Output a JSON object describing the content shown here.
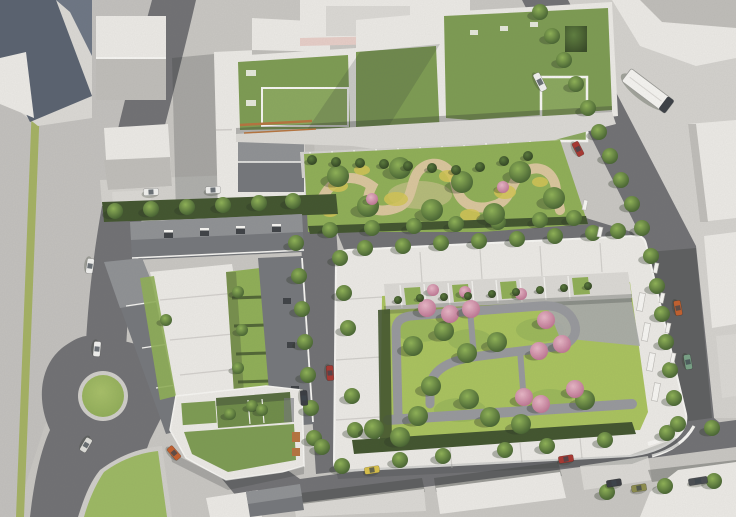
{
  "colors": {
    "pavement": "#c8c6c2",
    "pavement_left": "#c2c0bd",
    "pavement_light": "#d3d1cd",
    "road": "#717174",
    "island": "#cfcdc9",
    "verge": "#a4b163",
    "grass_island": "#9cb863",
    "lawn": "#8fae57",
    "lawn_bright": "#a9c25e",
    "lawn_dark": "#6f8c49",
    "green_roof": "#7d9b53",
    "green_roof_light": "#8aa75e",
    "hedge": "#42552f",
    "sand": "#d9c59c",
    "flower_yellow": "#d2c455",
    "building": "#ebe9e5",
    "building_mid": "#dad8d4",
    "building_shadow": "#bfbdb9",
    "roof_grey": "#75777b",
    "roof_grey_light": "#8f9194",
    "roof_slate": "#5a6270",
    "roof_slate_light": "#6d7684",
    "pink_parapet": "#e6cdc7",
    "orange_balcony": "#b5743f",
    "plaza_grey": "#a9aaac",
    "path_grey": "#97989c",
    "shadow": "#2e3230",
    "chimney": "#3f4246",
    "tree_light": "#8fb257",
    "tree_dark": "#3f5a2e",
    "bush_light": "#5a7a3c",
    "bush_dark": "#2c3d1f",
    "pink_light": "#e7b6c6",
    "pink_dark": "#b96e8d",
    "grass_light": "#a7bf68",
    "grass_dark": "#8aa754"
  },
  "scene": {
    "roundabout": {
      "cx": 103,
      "cy": 396,
      "r": 21
    },
    "bus": {
      "x": 648,
      "y": 91,
      "rot": 37,
      "w": 54,
      "h": 16
    },
    "trees": {
      "street": [
        [
          540,
          12
        ],
        [
          552,
          36
        ],
        [
          564,
          60
        ],
        [
          576,
          84
        ],
        [
          588,
          108
        ],
        [
          599,
          132
        ],
        [
          610,
          156
        ],
        [
          621,
          180
        ],
        [
          632,
          204
        ],
        [
          642,
          228
        ],
        [
          651,
          256
        ],
        [
          657,
          286
        ],
        [
          662,
          314
        ],
        [
          666,
          342
        ],
        [
          670,
          370
        ],
        [
          674,
          398
        ],
        [
          678,
          424
        ],
        [
          365,
          248
        ],
        [
          403,
          246
        ],
        [
          441,
          243
        ],
        [
          479,
          241
        ],
        [
          517,
          239
        ],
        [
          555,
          236
        ],
        [
          593,
          233
        ],
        [
          618,
          231
        ],
        [
          330,
          230
        ],
        [
          372,
          228
        ],
        [
          414,
          226
        ],
        [
          456,
          224
        ],
        [
          498,
          222
        ],
        [
          540,
          220
        ],
        [
          574,
          218
        ],
        [
          115,
          211
        ],
        [
          151,
          209
        ],
        [
          187,
          207
        ],
        [
          223,
          205
        ],
        [
          259,
          203
        ],
        [
          293,
          201
        ],
        [
          296,
          243
        ],
        [
          299,
          276
        ],
        [
          302,
          309
        ],
        [
          305,
          342
        ],
        [
          308,
          375
        ],
        [
          311,
          408
        ],
        [
          314,
          438
        ],
        [
          340,
          258
        ],
        [
          344,
          293
        ],
        [
          348,
          328
        ],
        [
          352,
          396
        ],
        [
          355,
          430
        ],
        [
          342,
          466
        ],
        [
          400,
          460
        ],
        [
          443,
          456
        ],
        [
          505,
          450
        ],
        [
          547,
          446
        ],
        [
          605,
          440
        ],
        [
          667,
          433
        ],
        [
          712,
          428
        ],
        [
          607,
          492
        ],
        [
          665,
          486
        ],
        [
          714,
          481
        ],
        [
          322,
          447
        ]
      ],
      "park": [
        [
          338,
          176
        ],
        [
          400,
          168
        ],
        [
          462,
          182
        ],
        [
          520,
          172
        ],
        [
          554,
          198
        ],
        [
          368,
          206
        ],
        [
          432,
          210
        ],
        [
          494,
          214
        ]
      ],
      "courtyard": [
        [
          413,
          346
        ],
        [
          444,
          331
        ],
        [
          467,
          353
        ],
        [
          431,
          386
        ],
        [
          469,
          399
        ],
        [
          497,
          342
        ],
        [
          418,
          416
        ],
        [
          490,
          417
        ],
        [
          374,
          429
        ],
        [
          400,
          437
        ],
        [
          521,
          424
        ],
        [
          585,
          400
        ]
      ],
      "pink_courtyard": [
        [
          427,
          308
        ],
        [
          450,
          314
        ],
        [
          471,
          309
        ],
        [
          546,
          320
        ],
        [
          562,
          344
        ],
        [
          539,
          351
        ],
        [
          524,
          397
        ],
        [
          541,
          404
        ],
        [
          575,
          389
        ]
      ],
      "pink_terrace": [
        [
          433,
          290
        ],
        [
          465,
          292
        ],
        [
          521,
          294
        ]
      ],
      "pink_shrubs": [
        [
          372,
          199
        ],
        [
          503,
          187
        ]
      ],
      "garden_bushes": [
        [
          312,
          160
        ],
        [
          336,
          162
        ],
        [
          360,
          163
        ],
        [
          384,
          164
        ],
        [
          408,
          166
        ],
        [
          432,
          168
        ],
        [
          456,
          170
        ],
        [
          480,
          167
        ],
        [
          504,
          161
        ],
        [
          528,
          156
        ]
      ],
      "small_court": [
        [
          238,
          292
        ],
        [
          242,
          330
        ],
        [
          238,
          368
        ],
        [
          252,
          406
        ],
        [
          166,
          320
        ],
        [
          230,
          414
        ],
        [
          262,
          410
        ]
      ],
      "terrace_hedge": [
        [
          398,
          300
        ],
        [
          420,
          298
        ],
        [
          444,
          297
        ],
        [
          468,
          296
        ],
        [
          492,
          294
        ],
        [
          516,
          292
        ],
        [
          540,
          290
        ],
        [
          564,
          288
        ],
        [
          588,
          286
        ]
      ]
    },
    "benches": [
      [
        656,
        268
      ],
      [
        662,
        298
      ],
      [
        668,
        328
      ],
      [
        673,
        358
      ],
      [
        585,
        205
      ],
      [
        600,
        232
      ]
    ],
    "balconies": [
      [
        641,
        302
      ],
      [
        646,
        332
      ],
      [
        651,
        362
      ],
      [
        656,
        392
      ]
    ],
    "cars": [
      {
        "x": 90,
        "y": 266,
        "rot": 98,
        "color": "#f0f0ee"
      },
      {
        "x": 97,
        "y": 349,
        "rot": 95,
        "color": "#f0f0ee"
      },
      {
        "x": 86,
        "y": 445,
        "rot": 120,
        "color": "#ddddd8"
      },
      {
        "x": 174,
        "y": 453,
        "rot": 49,
        "color": "#c2602f"
      },
      {
        "x": 151,
        "y": 192,
        "rot": -3,
        "color": "#f0f0ee"
      },
      {
        "x": 213,
        "y": 190,
        "rot": -3,
        "color": "#f0f0ee"
      },
      {
        "x": 330,
        "y": 373,
        "rot": 86,
        "color": "#a83832"
      },
      {
        "x": 304,
        "y": 398,
        "rot": 86,
        "color": "#3a3d42"
      },
      {
        "x": 540,
        "y": 82,
        "rot": 63,
        "color": "#f0f0ee",
        "van": true
      },
      {
        "x": 578,
        "y": 149,
        "rot": 63,
        "color": "#a83832"
      },
      {
        "x": 678,
        "y": 308,
        "rot": 80,
        "color": "#c2602f"
      },
      {
        "x": 688,
        "y": 362,
        "rot": 80,
        "color": "#79a186"
      },
      {
        "x": 372,
        "y": 470,
        "rot": -9,
        "color": "#d8c04a"
      },
      {
        "x": 566,
        "y": 459,
        "rot": -9,
        "color": "#a83832"
      },
      {
        "x": 614,
        "y": 483,
        "rot": -9,
        "color": "#3a3d42"
      },
      {
        "x": 639,
        "y": 488,
        "rot": -9,
        "color": "#8d8d4e"
      },
      {
        "x": 698,
        "y": 481,
        "rot": -9,
        "color": "#4a4d52",
        "van": true
      }
    ]
  }
}
